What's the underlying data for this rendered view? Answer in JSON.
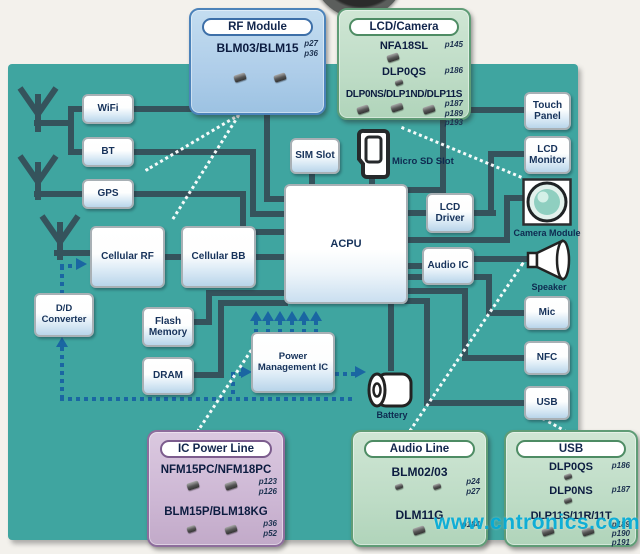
{
  "nodes": {
    "wifi": "WiFi",
    "bt": "BT",
    "gps": "GPS",
    "cellular_rf": "Cellular RF",
    "cellular_bb": "Cellular BB",
    "acpu": "ACPU",
    "sim_slot": "SIM Slot",
    "micro_sd_slot": "Micro SD Slot",
    "lcd_driver": "LCD Driver",
    "audio_ic": "Audio IC",
    "touch_panel": "Touch Panel",
    "lcd_monitor": "LCD Monitor",
    "camera_module": "Camera Module",
    "speaker": "Speaker",
    "mic": "Mic",
    "nfc": "NFC",
    "usb": "USB",
    "dd_converter": "D/D Converter",
    "flash_memory": "Flash Memory",
    "dram": "DRAM",
    "power_management_ic": "Power Management IC",
    "battery": "Battery"
  },
  "callouts": {
    "rf_module": {
      "title": "RF Module",
      "parts": [
        {
          "name": "BLM03/BLM15",
          "pages": [
            "p27",
            "p36"
          ]
        }
      ]
    },
    "lcd_camera": {
      "title": "LCD/Camera",
      "parts": [
        {
          "name": "NFA18SL",
          "pages": [
            "p145"
          ]
        },
        {
          "name": "DLP0QS",
          "pages": [
            "p186"
          ]
        },
        {
          "name": "DLP0NS/DLP1ND/DLP11S",
          "pages": [
            "p187",
            "p189",
            "p193"
          ]
        }
      ]
    },
    "ic_power_line": {
      "title": "IC Power Line",
      "parts": [
        {
          "name": "NFM15PC/NFM18PC",
          "pages": [
            "p123",
            "p126"
          ]
        },
        {
          "name": "BLM15P/BLM18KG",
          "pages": [
            "p36",
            "p52"
          ]
        }
      ]
    },
    "audio_line": {
      "title": "Audio Line",
      "parts": [
        {
          "name": "BLM02/03",
          "pages": [
            "p24",
            "p27"
          ]
        },
        {
          "name": "DLM11G",
          "pages": [
            "p184"
          ]
        }
      ]
    },
    "usb": {
      "title": "USB",
      "parts": [
        {
          "name": "DLP0QS",
          "pages": [
            "p186"
          ]
        },
        {
          "name": "DLP0NS",
          "pages": [
            "p187"
          ]
        },
        {
          "name": "DLP11S/11R/11T",
          "pages": [
            "p189",
            "p190",
            "p191"
          ]
        }
      ]
    }
  },
  "watermark": "www.cntronics.com",
  "icons": [
    "antenna-icon",
    "micro-sd-card-icon",
    "camera-module-icon",
    "speaker-icon",
    "battery-icon",
    "camera-lens-photo-icon",
    "component-photo-icon"
  ],
  "colors": {
    "panel_teal": "#3FA5A0",
    "connector_dark": "#35535C",
    "power_line_blue": "#1A66A2",
    "callout_blue_border": "#4C83BA",
    "callout_green_border": "#5F9C76",
    "callout_purple_border": "#8D6D9C",
    "watermark_cyan": "#00A9D6"
  }
}
